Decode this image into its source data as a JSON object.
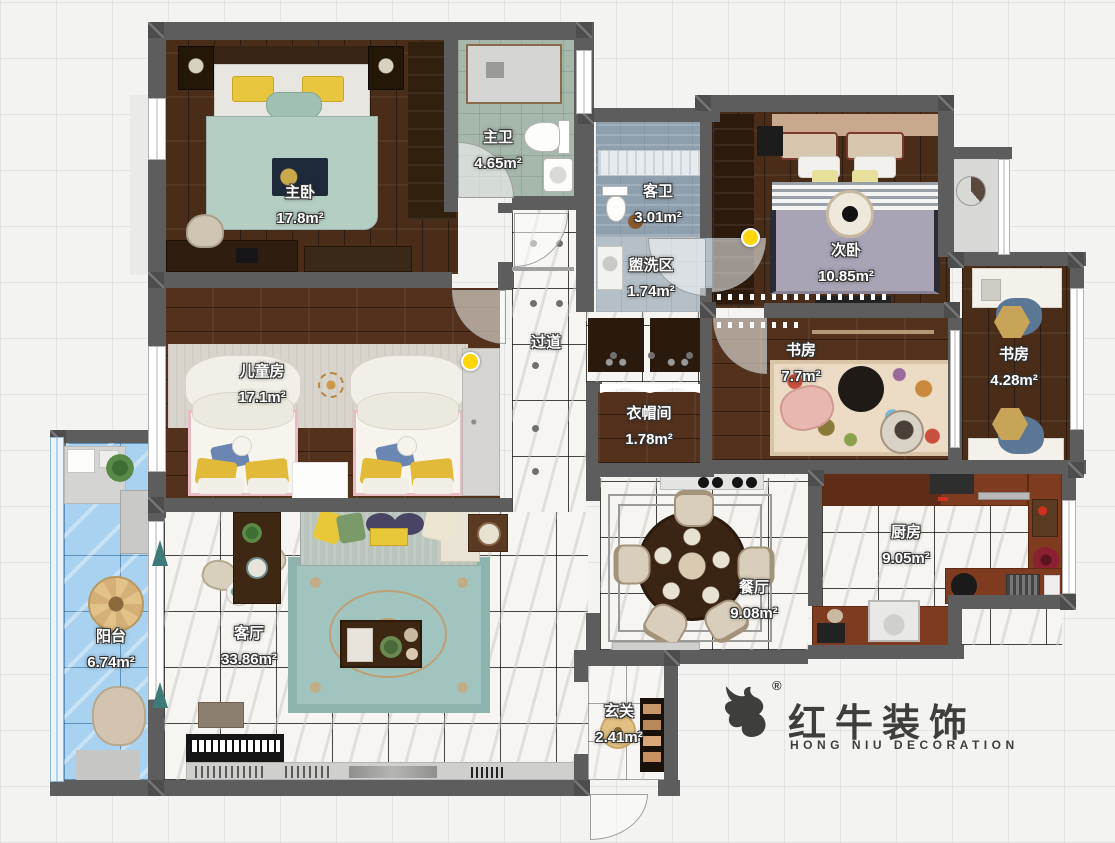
{
  "plan": {
    "rooms": [
      {
        "name": "主卧",
        "area": "17.8m²"
      },
      {
        "name": "主卫",
        "area": "4.65m²"
      },
      {
        "name": "客卫",
        "area": "3.01m²"
      },
      {
        "name": "盥洗区",
        "area": "1.74m²"
      },
      {
        "name": "次卧",
        "area": "10.85m²"
      },
      {
        "name": "过道",
        "area": ""
      },
      {
        "name": "书房",
        "area": "7.7m²"
      },
      {
        "name": "书房",
        "area": "4.28m²"
      },
      {
        "name": "儿童房",
        "area": "17.1m²"
      },
      {
        "name": "衣帽间",
        "area": "1.78m²"
      },
      {
        "name": "客厅",
        "area": "33.86m²"
      },
      {
        "name": "阳台",
        "area": "6.74m²"
      },
      {
        "name": "餐厅",
        "area": "9.08m²"
      },
      {
        "name": "厨房",
        "area": "9.05m²"
      },
      {
        "name": "玄关",
        "area": "2.41m²"
      }
    ],
    "markers": {
      "light_dot_color": "#ffd60a",
      "light_dot_count": 2
    }
  },
  "logo": {
    "brand": "红牛装饰",
    "subtitle": "HONG NIU DECORATION",
    "registered": "®"
  },
  "colors": {
    "wall": "#5d5d5d",
    "wood_floor": "#4a2d18",
    "marble_floor": "#f6f5f2",
    "master_bath_tile": "#a6b7ab",
    "guest_bath_tile": "#8e9fae",
    "wash_tile": "#b4bfc7",
    "balcony_tile": "#a9d2f0",
    "living_rug": "#a2c4be",
    "study_rug": "#ecdcc6",
    "master_bed_blanket": "#b5cec3",
    "second_bed_blanket": "#a8a3b5",
    "logo_color": "#3e3e3c"
  }
}
